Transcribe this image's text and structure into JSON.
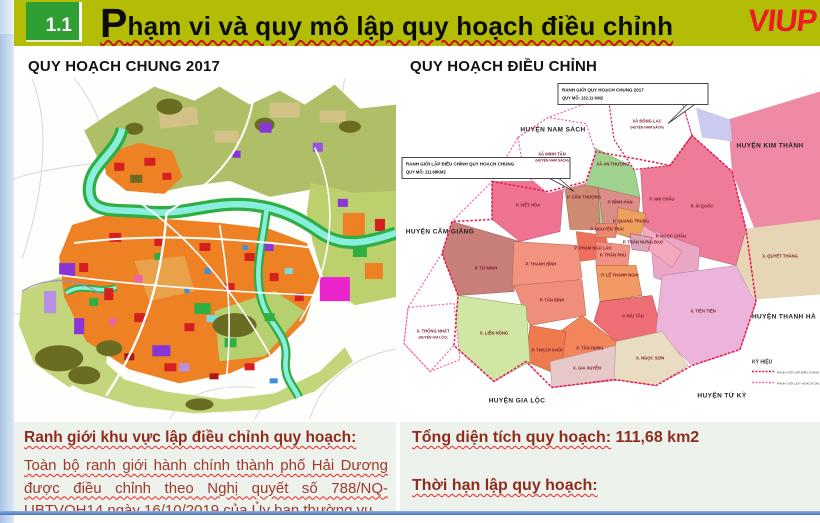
{
  "colors": {
    "header_bg": "#b4bd05",
    "badge_green": "#2f9e33",
    "logo_red": "#ea1c24",
    "text_dark_red": "#9c392b",
    "heading_red": "#8f2c1e",
    "bottom_bar_blue": "#4472c4",
    "boundary_adjust_red": "#e11a45",
    "boundary_2017_pink": "#f06cb4"
  },
  "header": {
    "section_number": "1.1",
    "title_initial": "P",
    "title_rest": "hạm vi và quy mô lập quy hoạch điều chỉnh",
    "logo_text": "VIUP"
  },
  "left_map": {
    "title": "QUY HOẠCH CHUNG 2017"
  },
  "right_map": {
    "title": "QUY HOẠCH ĐIỀU CHỈNH",
    "callout_2017": {
      "line1": "RANH GIỚI QUY HOẠCH CHUNG 2017",
      "line2": "QUY MÔ: 132.11 KM2"
    },
    "callout_adjust": {
      "line1": "RANH GIỚI LẬP ĐIỀU CHỈNH QUY HOẠCH CHUNG",
      "line2": "QUY MÔ: 111.68KM2"
    },
    "districts": [
      "HUYỆN NAM SÁCH",
      "HUYỆN KIM THÀNH",
      "HUYỆN CẨM GIÀNG",
      "HUYỆN THANH HÀ",
      "HUYỆN GIA LỘC",
      "HUYỆN TỨ KỲ"
    ],
    "wards": [
      {
        "name": "XÃ MINH TÂN",
        "sub": "(HUYỆN NAM SÁCH)"
      },
      {
        "name": "XÃ ĐỒNG LẠC",
        "sub": "(HUYỆN NAM SÁCH)"
      },
      {
        "name": "XÃ AN THƯỢNG"
      },
      {
        "name": "P. ÁI QUỐC"
      },
      {
        "name": "P. VIỆT HÒA"
      },
      {
        "name": "P. CẨM THƯỢNG"
      },
      {
        "name": "P. BÌNH HÀN"
      },
      {
        "name": "P. NHỊ CHÂU"
      },
      {
        "name": "P. TỨ MINH"
      },
      {
        "name": "P. THANH BÌNH"
      },
      {
        "name": "P. PHẠM NGŨ LÃO"
      },
      {
        "name": "P. NGUYỄN TRÃI"
      },
      {
        "name": "P. QUANG TRUNG"
      },
      {
        "name": "P. TRẦN PHÚ"
      },
      {
        "name": "P. TRẦN HƯNG ĐẠO"
      },
      {
        "name": "P. NGỌC CHÂU"
      },
      {
        "name": "P. LÊ THANH NGHỊ"
      },
      {
        "name": "X. QUYẾT THẮNG"
      },
      {
        "name": "P. TÂN BÌNH"
      },
      {
        "name": "P. HẢI TÂN"
      },
      {
        "name": "X. LIÊN HỒNG"
      },
      {
        "name": "P. THẠCH KHÔI"
      },
      {
        "name": "P. TÂN HƯNG"
      },
      {
        "name": "X. TIỀN TIẾN"
      },
      {
        "name": "X. GIA XUYÊN"
      },
      {
        "name": "X. NGỌC SƠN"
      },
      {
        "name": "X. THỐNG NHẤT",
        "sub": "(HUYỆN GIA LỘC)"
      }
    ],
    "legend": {
      "title": "KÝ HIỆU",
      "items": [
        "RANH GIỚI LẬP ĐIỀU CHỈNH QUY HOẠCH CHUNG",
        "RANH GIỚI QUY HOẠCH CHUNG NĂM 2017"
      ]
    }
  },
  "bottom_left": {
    "heading": "Ranh giới khu vực lập điều chỉnh quy hoạch:",
    "body": "Toàn bộ ranh giới hành chính thành phố Hải Dương được điều chỉnh theo Nghị quyết số 788/NQ-UBTVQH14 ngày 16/10/2019 của Ủy ban thường vụ"
  },
  "bottom_right": {
    "area_label": "Tổng diện tích quy hoạch:",
    "area_value": " 111,68 km2",
    "deadline_label": "Thời hạn lập quy hoạch:"
  }
}
